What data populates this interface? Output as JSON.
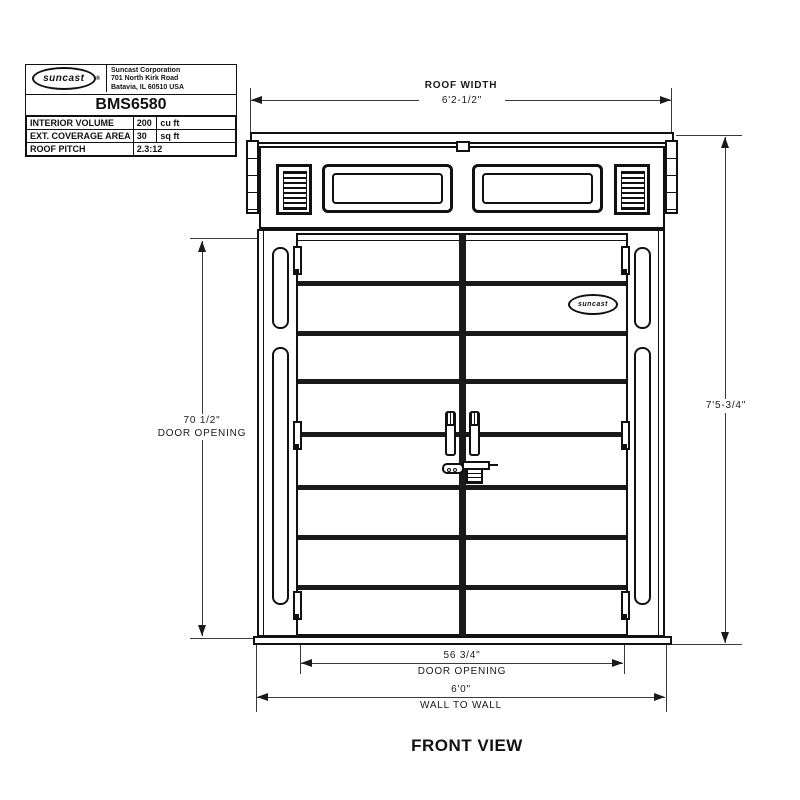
{
  "colors": {
    "line": "#111111",
    "dim_line": "#3a3a3a",
    "background": "#ffffff"
  },
  "title_block": {
    "logo_text": "suncast",
    "logo_reg": "®",
    "company": "Suncast Corporation",
    "address_line1": "701 North Kirk Road",
    "address_line2": "Batavia, IL 60510 USA",
    "model": "BMS6580",
    "specs": [
      {
        "label": "INTERIOR VOLUME",
        "value": "200",
        "unit": "cu ft"
      },
      {
        "label": "EXT. COVERAGE AREA",
        "value": "30",
        "unit": "sq ft"
      },
      {
        "label": "ROOF PITCH",
        "value": "2.3:12",
        "unit": ""
      }
    ]
  },
  "drawing": {
    "view_label": "FRONT VIEW",
    "door_logo_text": "suncast",
    "dims": {
      "roof_width": {
        "title": "ROOF WIDTH",
        "value": "6'2-1/2\""
      },
      "overall_height": {
        "value": "7'5-3/4\""
      },
      "door_opening_height": {
        "value": "70 1/2\"",
        "label": "DOOR OPENING"
      },
      "door_opening_width": {
        "value": "56 3/4\"",
        "label": "DOOR OPENING"
      },
      "wall_to_wall": {
        "value": "6'0\"",
        "label": "WALL TO WALL"
      }
    }
  }
}
